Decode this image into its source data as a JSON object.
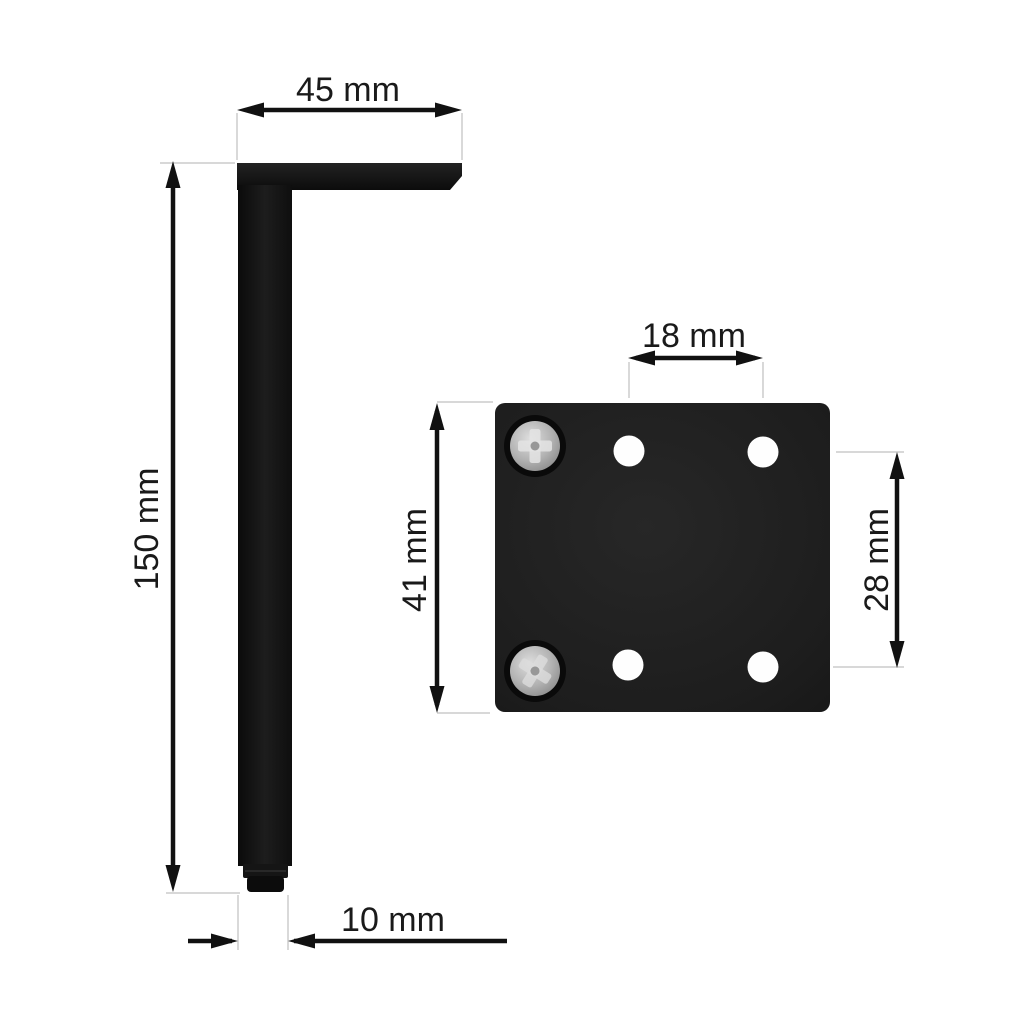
{
  "page": {
    "type": "product-dimension-diagram",
    "background": "#ffffff"
  },
  "dimensions": {
    "bracket_width": {
      "label": "45 mm",
      "value": 45,
      "unit": "mm"
    },
    "leg_height": {
      "label": "150 mm",
      "value": 150,
      "unit": "mm"
    },
    "foot_size": {
      "label": "10 mm",
      "value": 10,
      "unit": "mm"
    },
    "hole_spacing_horizontal": {
      "label": "18 mm",
      "value": 18,
      "unit": "mm"
    },
    "plate_height": {
      "label": "41 mm",
      "value": 41,
      "unit": "mm"
    },
    "hole_spacing_vertical": {
      "label": "28 mm",
      "value": 28,
      "unit": "mm"
    }
  },
  "colors": {
    "background": "#ffffff",
    "metal_black": "#101010",
    "plate_black": "#1d1d1d",
    "screw_silver": "#b5b5b5",
    "hole_white": "#fefefe",
    "dimension_line": "#111111",
    "extension_line": "#cccccc",
    "label_text": "#1a1a1a"
  }
}
